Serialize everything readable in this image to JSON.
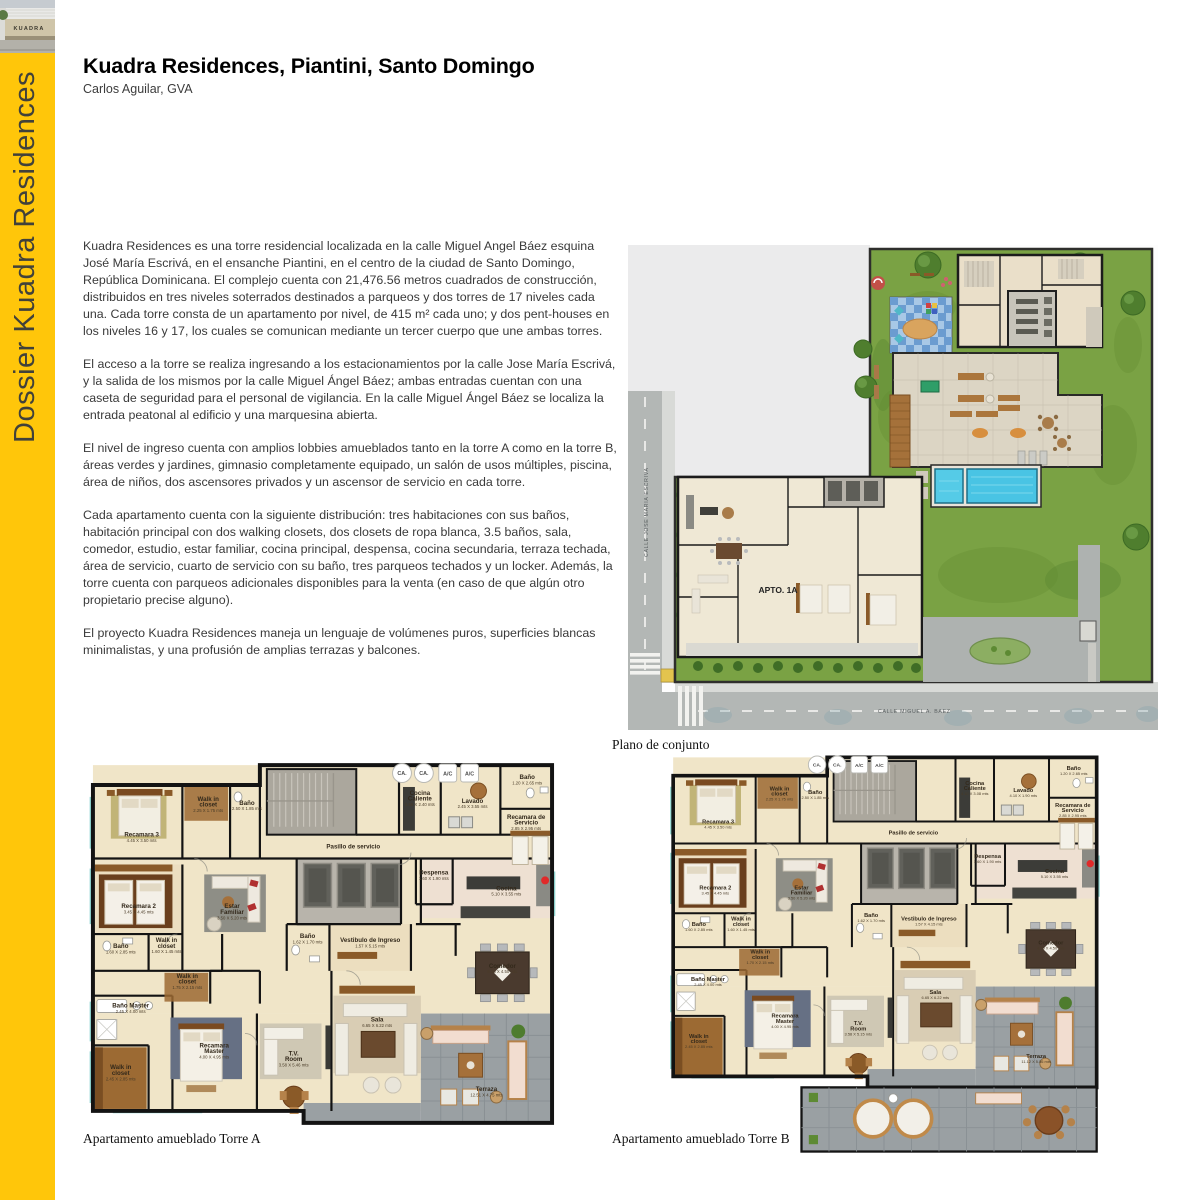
{
  "header": {
    "title": "Kuadra Residences, Piantini, Santo Domingo",
    "subtitle": "Carlos Aguilar, GVA"
  },
  "sidebar": {
    "vertical_label": "Dossier Kuadra Residences",
    "thumbnail_sign_text": "KUADRA",
    "accent_color": "#FFC60A"
  },
  "paragraphs": [
    "Kuadra Residences es una torre residencial localizada en la calle Miguel Angel Báez esquina José María Escrivá, en el ensanche Piantini, en el centro de la ciudad de Santo Domingo, República Dominicana. El complejo cuenta con 21,476.56 metros cuadrados de construcción, distribuidos en tres niveles soterrados destinados a parqueos y dos torres de 17 niveles cada una. Cada torre consta de un apartamento por nivel, de 415 m² cada uno; y dos pent-houses en los niveles 16 y 17, los cuales se comunican mediante un tercer cuerpo que une ambas torres.",
    "El acceso a la torre se realiza ingresando a los estacionamientos por la calle Jose María Escrivá, y la salida de los mismos por la calle Miguel Ángel Báez; ambas entradas cuentan con una caseta de seguridad para el personal de vigilancia. En la calle Miguel Ángel Báez se localiza la entrada peatonal al edificio y una marquesina abierta.",
    "El nivel de ingreso cuenta con amplios lobbies amueblados tanto en la torre A como en la torre B, áreas verdes y jardines, gimnasio completamente equipado, un salón de usos múltiples, piscina, área de niños, dos ascensores privados y un ascensor de servicio en cada torre.",
    "Cada apartamento cuenta con la siguiente distribución: tres habitaciones con sus baños, habitación principal con dos walking closets, dos closets de ropa blanca, 3.5 baños, sala, comedor, estudio, estar familiar, cocina principal, despensa, cocina secundaria, terraza techada, área de servicio, cuarto de servicio con su baño, tres parqueos techados y un locker. Además, la torre cuenta con parqueos adicionales disponibles para la venta (en caso de que algún otro propietario precise alguno).",
    "El proyecto Kuadra Residences maneja un lenguaje de volúmenes puros, superficies blancas minimalistas, y una profusión de amplias terrazas y balcones."
  ],
  "site_plan": {
    "caption": "Plano de conjunto",
    "apto_label": "APTO. 1A",
    "street_left": "CALLE  JOSE MARIA ESCRIVA",
    "street_bottom": "CALLE  MIGUEL A. BAEZ"
  },
  "floor_plans": {
    "badges": [
      "CA.",
      "CA.",
      "A/C",
      "A/C"
    ],
    "torre_a": {
      "caption": "Apartamento amueblado Torre A",
      "rooms": [
        {
          "name": "Recamara 3",
          "dims": "4.45 X 3.50 mts",
          "x": 59,
          "y": 80
        },
        {
          "name": "Walk in",
          "name2": "closet",
          "dims": "2.25 X 1.75 mts",
          "x": 126,
          "y": 44
        },
        {
          "name": "Baño",
          "dims": "2.50 X 1.85 mts",
          "x": 165,
          "y": 48
        },
        {
          "name": "Cocina",
          "name2": "Caliente",
          "dims": "1.66 X 2.40 mts",
          "x": 339,
          "y": 38
        },
        {
          "name": "Lavado",
          "dims": "2.45 X 3.55 mts",
          "x": 392,
          "y": 46
        },
        {
          "name": "Baño",
          "dims": "1.20 X 2.65 mts",
          "x": 447,
          "y": 22
        },
        {
          "name": "Recamara de",
          "name2": "Servicio",
          "dims": "2.85 X 2.95 mts",
          "x": 446,
          "y": 62
        },
        {
          "name": "Pasillo de servicio",
          "x": 272,
          "y": 92
        },
        {
          "name": "Recamara 2",
          "dims": "3.45 X 4.45 mts",
          "x": 56,
          "y": 152
        },
        {
          "name": "Estar",
          "name2": "Familiar",
          "dims": "3.50 X 5.20 mts",
          "x": 150,
          "y": 152
        },
        {
          "name": "Despensa",
          "dims": "1.60 X 1.90 mts",
          "x": 353,
          "y": 118
        },
        {
          "name": "Cocina",
          "dims": "5.10 X 3.55 mts",
          "x": 426,
          "y": 134
        },
        {
          "name": "Baño",
          "dims": "1.60 X 2.85 mts",
          "x": 38,
          "y": 192
        },
        {
          "name": "Walk in",
          "name2": "closet",
          "dims": "1.60 X 1.45 mts",
          "x": 84,
          "y": 186
        },
        {
          "name": "Baño",
          "dims": "1.62 X 1.70 mts",
          "x": 226,
          "y": 182
        },
        {
          "name": "Vestibulo de Ingreso",
          "dims": "1.57 X 5.15 mts",
          "x": 289,
          "y": 186
        },
        {
          "name": "Walk in",
          "name2": "closet",
          "dims": "1.75 X 2.15 mts",
          "x": 105,
          "y": 222
        },
        {
          "name": "Comedor",
          "dims": "5.16 X 4.50 mts",
          "x": 422,
          "y": 212
        },
        {
          "name": "Baño Master",
          "dims": "2.45 X 4.00 mts",
          "x": 48,
          "y": 252
        },
        {
          "name": "Recamara",
          "name2": "Master",
          "dims": "4.00 X 4.95 mts",
          "x": 132,
          "y": 292
        },
        {
          "name": "Walk in",
          "name2": "closet",
          "dims": "2.45 X 2.85 mts",
          "x": 38,
          "y": 314
        },
        {
          "name": "T.V.",
          "name2": "Room",
          "dims": "3.58 X 5.46 mts",
          "x": 212,
          "y": 300
        },
        {
          "name": "Sala",
          "dims": "6.65 X 6.22 mts",
          "x": 296,
          "y": 266
        },
        {
          "name": "Terraza",
          "dims": "12.51 X 4.75 mts",
          "x": 406,
          "y": 336
        }
      ]
    },
    "torre_b": {
      "caption": "Apartamento amueblado Torre B",
      "rooms": [
        {
          "name": "Recamara 3",
          "dims": "4.45 X 3.50 mts",
          "x": 59,
          "y": 80
        },
        {
          "name": "Walk in",
          "name2": "closet",
          "dims": "2.25 X 1.75 mts",
          "x": 126,
          "y": 44
        },
        {
          "name": "Baño",
          "dims": "2.50 X 1.85 mts",
          "x": 165,
          "y": 48
        },
        {
          "name": "Cocina",
          "name2": "Caliente",
          "dims": "4.10 X 3.08 mts",
          "x": 339,
          "y": 38
        },
        {
          "name": "Lavado",
          "dims": "4.10 X 1.90 mts",
          "x": 392,
          "y": 46
        },
        {
          "name": "Baño",
          "dims": "1.20 X 2.65 mts",
          "x": 447,
          "y": 22
        },
        {
          "name": "Recamara de",
          "name2": "Servicio",
          "dims": "2.85 X 2.95 mts",
          "x": 446,
          "y": 62
        },
        {
          "name": "Pasillo de servicio",
          "x": 272,
          "y": 92
        },
        {
          "name": "Recamara 2",
          "dims": "3.45 X 4.45 mts",
          "x": 56,
          "y": 152
        },
        {
          "name": "Estar",
          "name2": "Familiar",
          "dims": "3.50 X 5.20 mts",
          "x": 150,
          "y": 152
        },
        {
          "name": "Despensa",
          "dims": "1.60 X 1.90 mts",
          "x": 353,
          "y": 118
        },
        {
          "name": "Cocina",
          "dims": "5.10 X 3.55 mts",
          "x": 426,
          "y": 134
        },
        {
          "name": "Baño",
          "dims": "1.60 X 2.85 mts",
          "x": 38,
          "y": 192
        },
        {
          "name": "Walk in",
          "name2": "closet",
          "dims": "1.60 X 1.45 mts",
          "x": 84,
          "y": 186
        },
        {
          "name": "Baño",
          "dims": "1.62 X 1.70 mts",
          "x": 226,
          "y": 182
        },
        {
          "name": "Vestibulo de Ingreso",
          "dims": "1.57 X 4.15 mts",
          "x": 289,
          "y": 186
        },
        {
          "name": "Walk in",
          "name2": "closet",
          "dims": "1.70 X 2.15 mts",
          "x": 105,
          "y": 222
        },
        {
          "name": "Comedor",
          "dims": "4.35 X 4.50 mts",
          "x": 422,
          "y": 212
        },
        {
          "name": "Baño Master",
          "dims": "2.45 X 4.00 mts",
          "x": 48,
          "y": 252
        },
        {
          "name": "Recamara",
          "name2": "Master",
          "dims": "4.00 X 4.95 mts",
          "x": 132,
          "y": 292
        },
        {
          "name": "Walk in",
          "name2": "closet",
          "dims": "2.45 X 2.85 mts",
          "x": 38,
          "y": 314
        },
        {
          "name": "T.V.",
          "name2": "Room",
          "dims": "3.58 X 5.15 mts",
          "x": 212,
          "y": 300
        },
        {
          "name": "Sala",
          "dims": "6.65 X 6.22 mts",
          "x": 296,
          "y": 266
        },
        {
          "name": "Terraza",
          "dims": "11.12 X 5.86 mts",
          "x": 406,
          "y": 336
        }
      ]
    }
  }
}
